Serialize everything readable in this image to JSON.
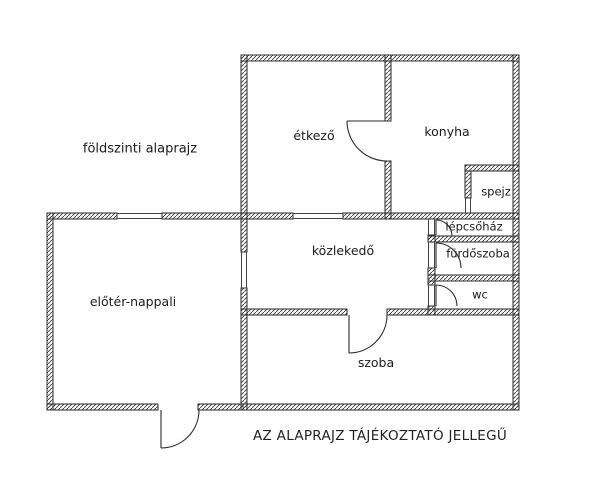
{
  "plan": {
    "title": "földszinti alaprajz",
    "disclaimer": "AZ ALAPRAJZ TÁJÉKOZTATÓ JELLEGŰ",
    "rooms": {
      "etkezo": "étkező",
      "konyha": "konyha",
      "spejz": "spejz",
      "lepcsohaz": "lépcsőház",
      "furdoszoba": "fürdőszoba",
      "wc": "wc",
      "kozlekedo": "közlekedő",
      "eloter_nappali": "előtér-nappali",
      "szoba": "szoba"
    }
  },
  "colors": {
    "background": "#ffffff",
    "wall_line": "#2a2a2a",
    "hatch_line": "#3a3a3a",
    "text": "#1b1b1b"
  }
}
